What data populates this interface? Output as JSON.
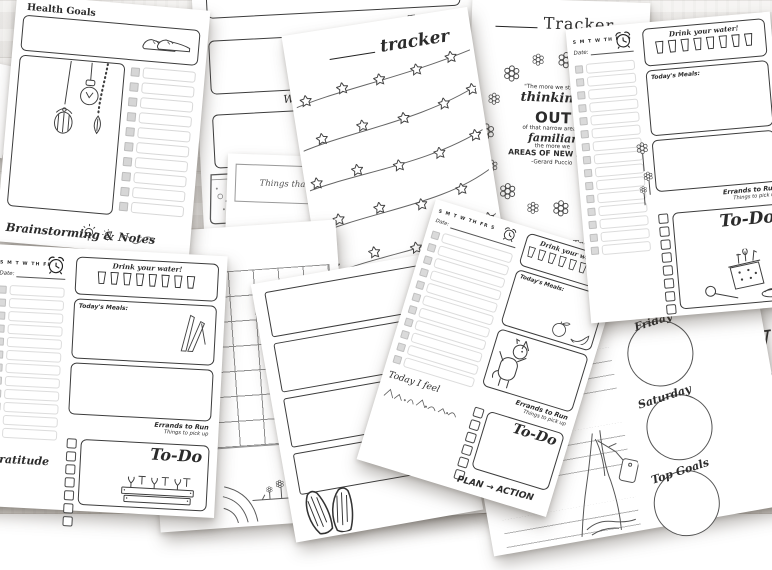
{
  "colors": {
    "paper": "#ffffff",
    "ink": "#2b2b2b",
    "wood": "#e9e6e2"
  },
  "pages": {
    "health_goals": {
      "title": "Health Goals",
      "footer": "Brainstorming & Notes"
    },
    "weekly_days": {
      "tuesday_label": "Tuesday",
      "wednesday_partial_label": "We"
    },
    "things_warmed": {
      "caption": "Things that warmed"
    },
    "star_tracker": {
      "title": "tracker"
    },
    "wreath_tracker": {
      "title": "Tracker",
      "quote_line1": "\"The more we stretch",
      "quote_line2": "thinking,",
      "quote_line3": "the mo",
      "quote_line4": "OUT",
      "quote_line5": "of that narrow area of",
      "quote_line6": "familiar",
      "quote_line7": "the more we",
      "quote_line8": "AREAS OF NEW DISC",
      "quote_attribution": "-Gerard Puccio",
      "footer": "Tracker Key"
    },
    "daily": {
      "days_header": "S M T W TH FR S",
      "date_label": "Date:",
      "water_label": "Drink your water!",
      "meals_label": "Today's Meals:",
      "errands_label": "Errands to Run",
      "pickup_label": "Things to pick up",
      "todo_label": "To-Do",
      "gratitude_label": "Gratitude",
      "feel_label": "Today I feel",
      "plan_label": "PLAN → ACTION"
    },
    "circle_weekly": {
      "day_thursday": "Thursday",
      "day_friday": "Friday",
      "day_saturday": "Saturday",
      "top_goals_label": "Top Goals"
    },
    "w_page": {
      "title": "W"
    },
    "weather_sliver": {
      "icons_row": "✿ ☀ ☁ ♡ ☆"
    }
  },
  "doodles": {
    "health_goals": "hanging lightbulb, birdcage lantern and bead-leaf strand; sneakers; suns",
    "weekly_days": "patterned rain boots, two pairs",
    "star_tracker": "five star garlands",
    "wreath_tracker": "flower wreath around quote",
    "daily_pages": "alarm clock, water cups, flowers, asparagus, picnic basket, garden bed, unicorn, fruit, mountains",
    "calendar": "treehouse on a cliff",
    "weekly_boxes": "swim fins",
    "circle_weekly": "tree with hanging tag"
  }
}
